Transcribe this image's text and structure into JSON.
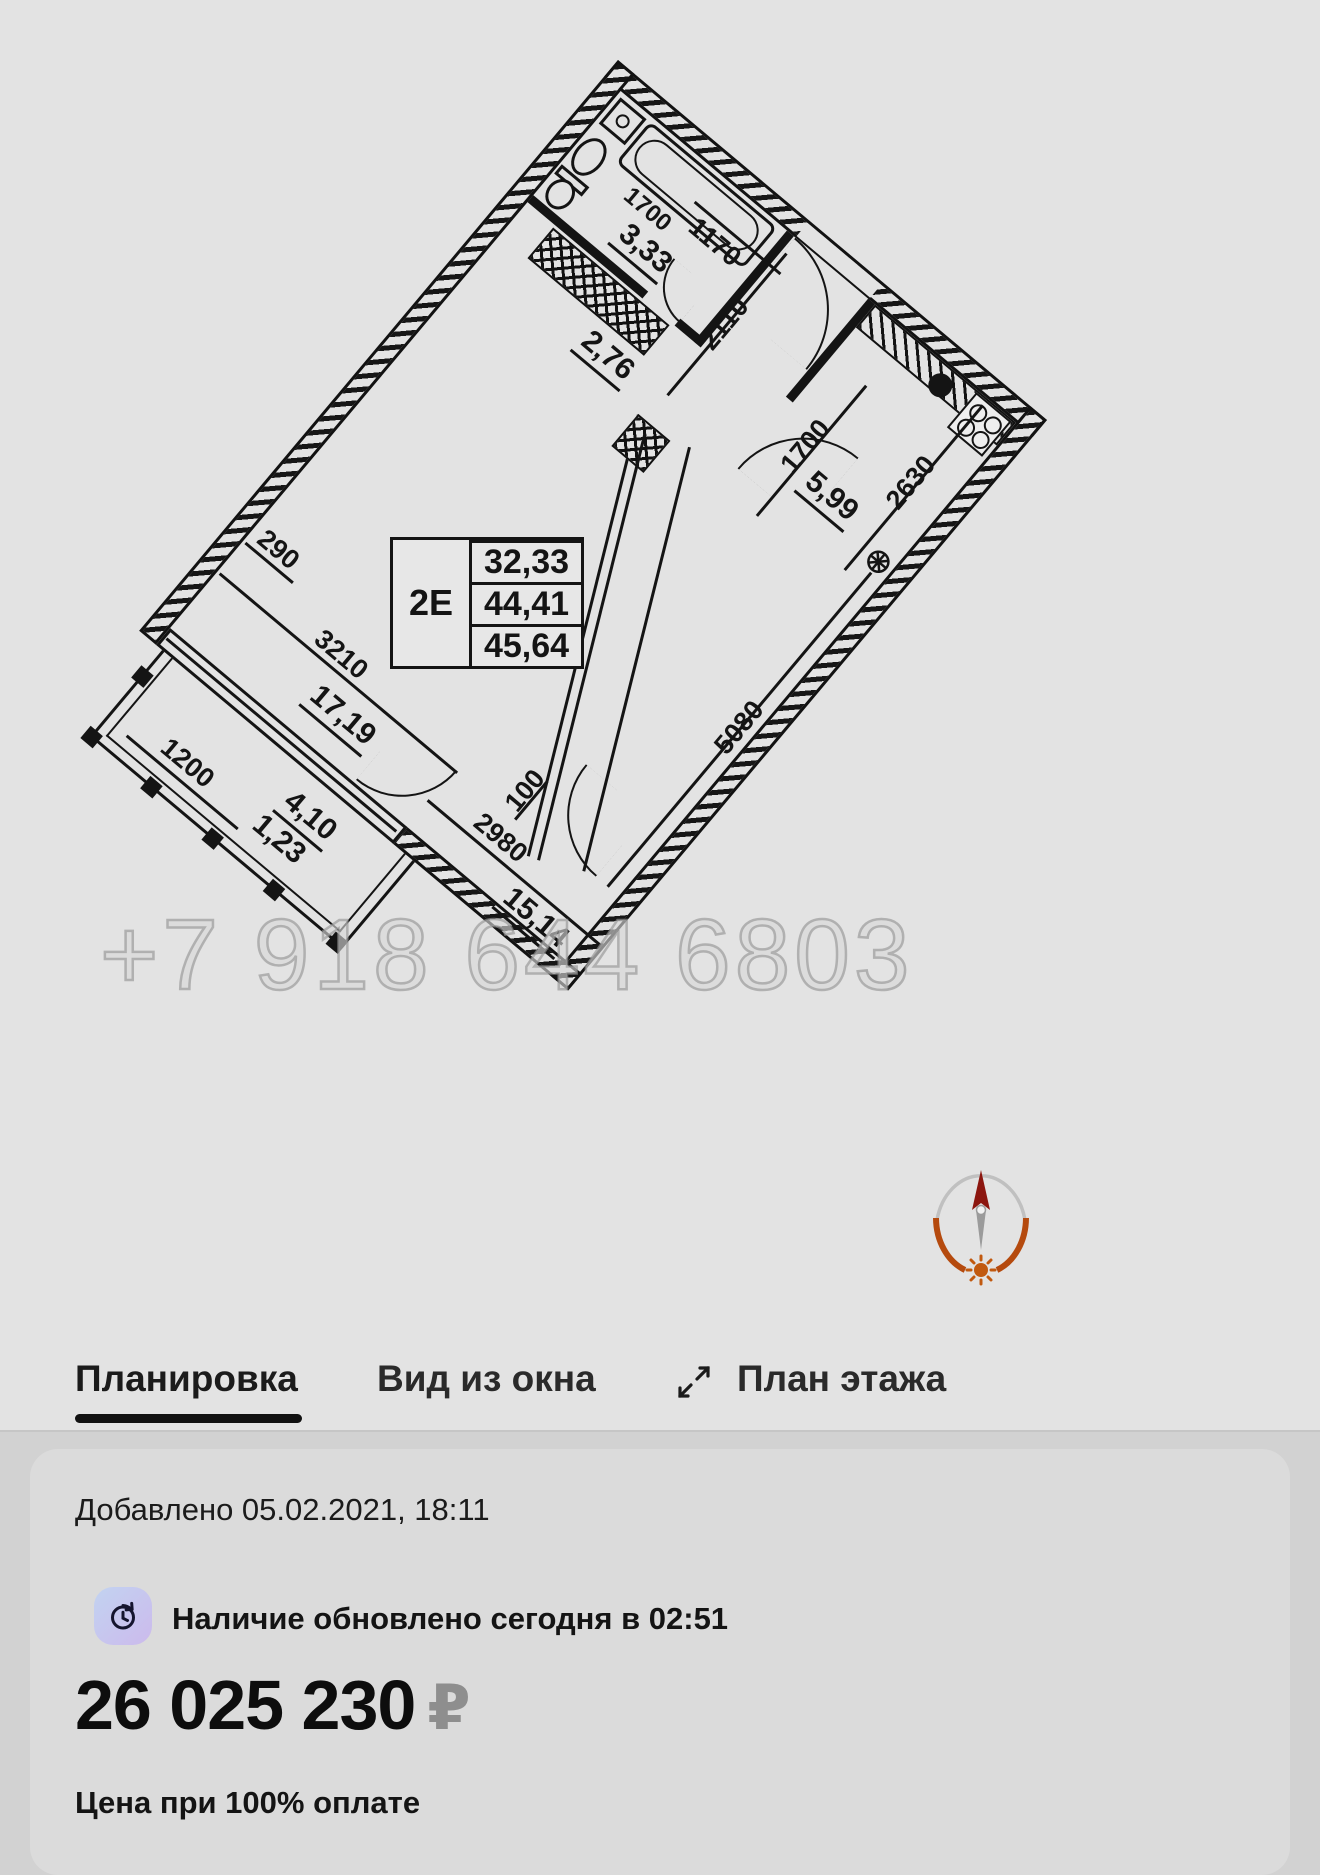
{
  "tabs": {
    "planirovka": "Планировка",
    "vid_iz_okna": "Вид из окна",
    "plan_etazha": "План этажа"
  },
  "card": {
    "added": "Добавлено 05.02.2021, 18:11",
    "availability": "Наличие обновлено сегодня в 02:51",
    "price": "26 025 230",
    "currency": "₽",
    "price_note": "Цена при 100% оплате"
  },
  "watermark": "+7 918 644 6803",
  "floorplan": {
    "unit_table": {
      "unit": "2Е",
      "living_area": "32,33",
      "area": "44,41",
      "total_area": "45,64"
    },
    "areas": {
      "bathroom": "3,33",
      "hall": "2,76",
      "kitchen": "5,99",
      "living": "17,19",
      "bedroom": "15,14",
      "balcony": "4,10",
      "balcony_k": "1,23"
    },
    "dims": {
      "bath_len": "1700",
      "entry": "1170",
      "hall_w": "2110",
      "kitchen_w": "2630",
      "kitchen_door": "1700",
      "corridor": "5480",
      "wall_290": "290",
      "living_w": "3210",
      "balcony_w": "1200",
      "wall_100": "100",
      "bedroom_w": "2980",
      "bedroom_l": "5080"
    }
  }
}
